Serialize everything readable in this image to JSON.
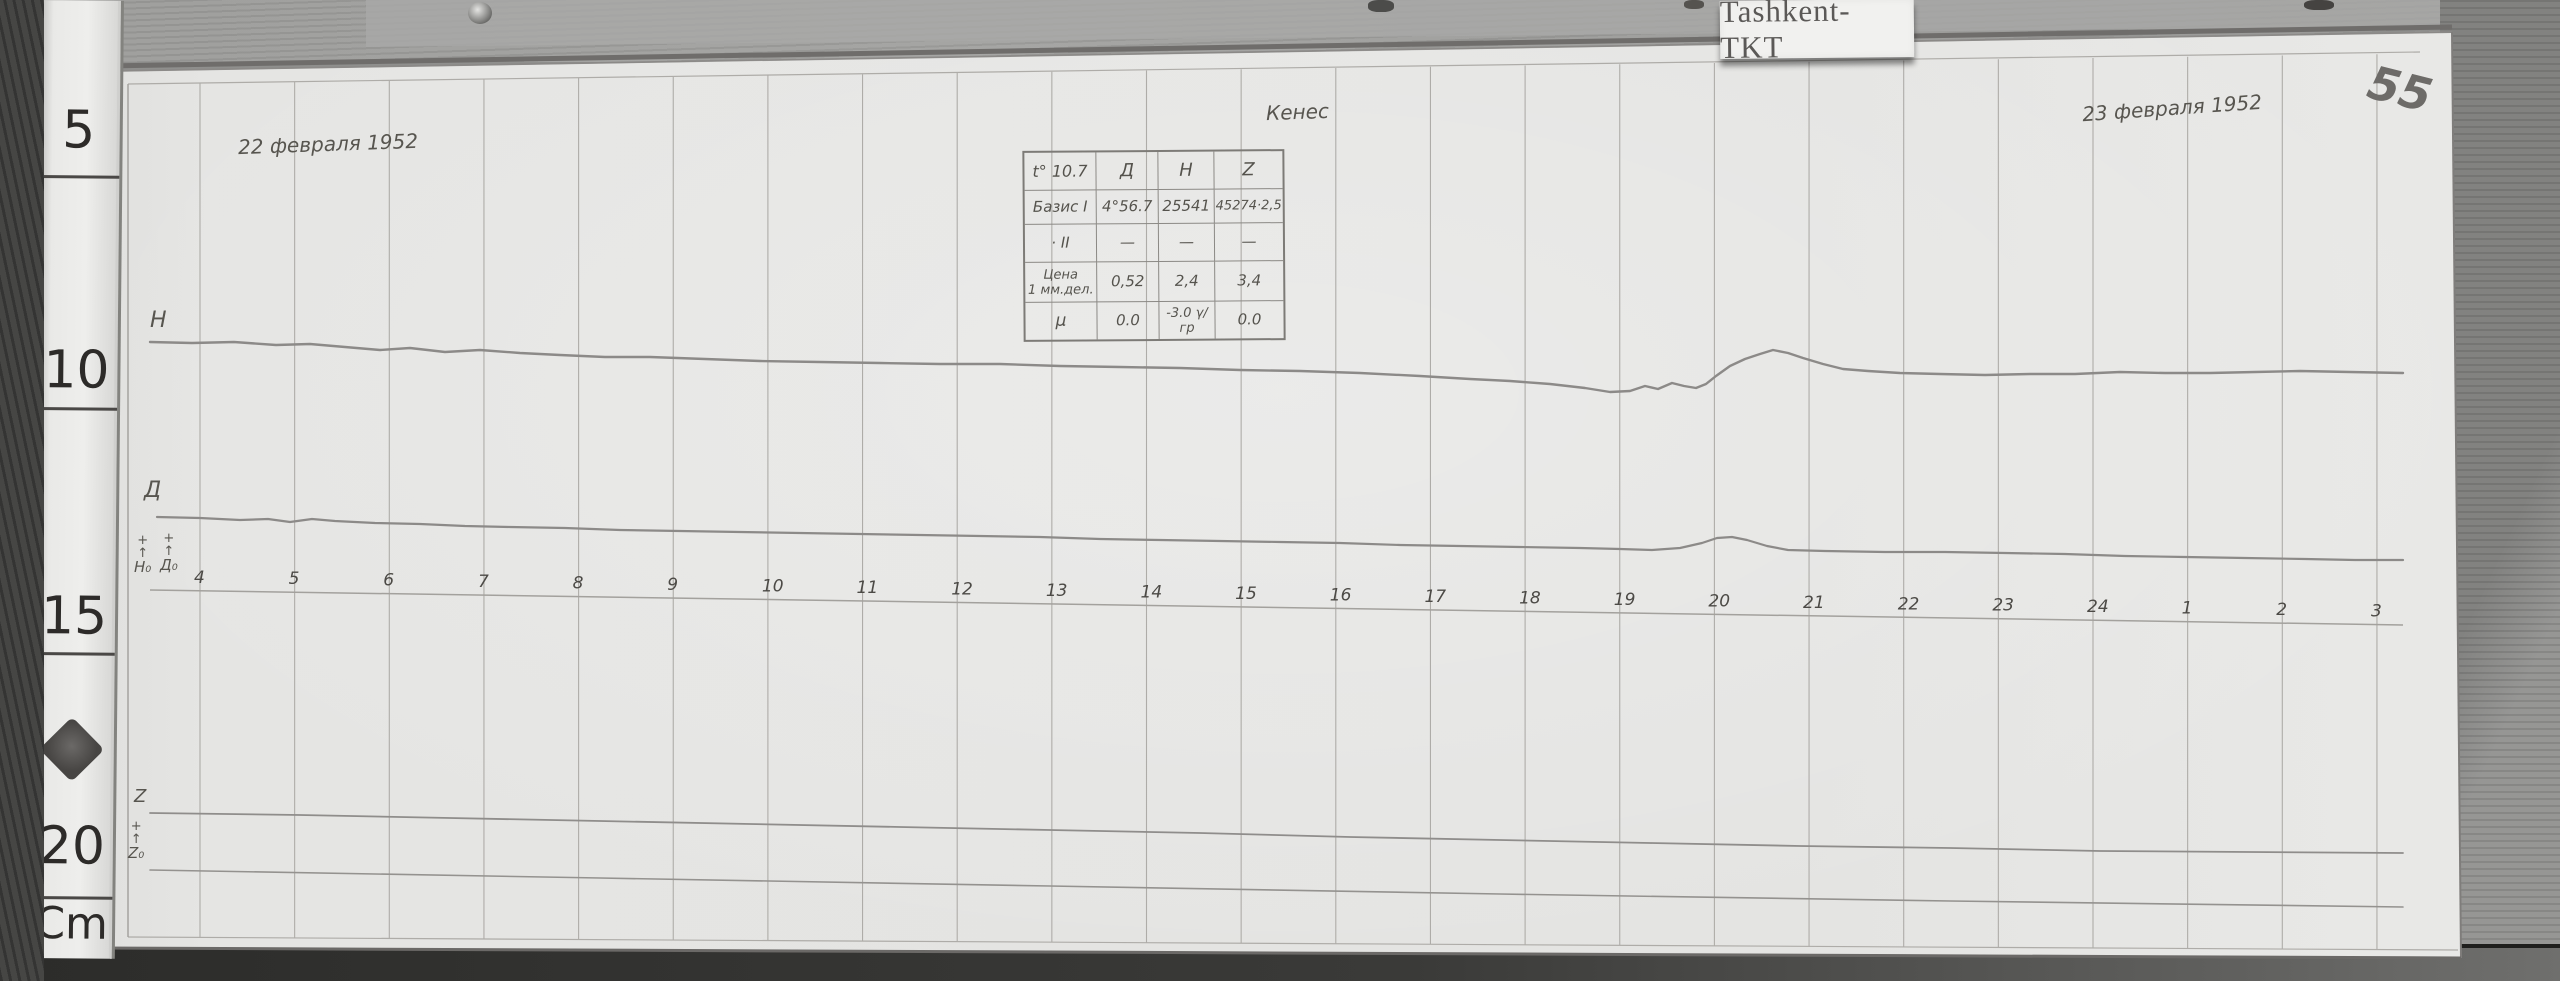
{
  "label_card": {
    "text": "Tashkent-TKT"
  },
  "annotations": {
    "date_left": "22 февраля 1952",
    "date_right": "23 февраля 1952",
    "center_note": "Кенес",
    "page_number": "55"
  },
  "ruler": {
    "marks": [
      {
        "label": "5"
      },
      {
        "label": "10"
      },
      {
        "label": "15"
      },
      {
        "label": "20"
      },
      {
        "label": "Cm"
      }
    ]
  },
  "table": {
    "rows": [
      {
        "cells": [
          "t° 10.7",
          "Д",
          "Н",
          "Z"
        ]
      },
      {
        "cells": [
          "Базис I",
          "4°56.7",
          "25541",
          "45274·2,5"
        ]
      },
      {
        "cells": [
          "· II",
          "—",
          "—",
          "—"
        ]
      },
      {
        "cells": [
          "Цена\n1 мм.дел.",
          "0,52",
          "2,4",
          "3,4"
        ]
      },
      {
        "cells": [
          "μ",
          "0.0",
          "-3.0 γ/гр",
          "0.0"
        ]
      }
    ]
  },
  "chart_data": {
    "type": "line",
    "description": "Photographed magnetogram strip (components H, D, Z with Z baseline) recorded 22–23 February 1952 at Tashkent-TKT; horizontal axis is local time in hours, vertical deflections unlabeled (scale values given in handwritten table).",
    "x_axis": {
      "unit": "hour",
      "labels": [
        "4",
        "5",
        "6",
        "7",
        "8",
        "9",
        "10",
        "11",
        "12",
        "13",
        "14",
        "15",
        "16",
        "17",
        "18",
        "19",
        "20",
        "21",
        "22",
        "23",
        "24",
        "1",
        "2",
        "3"
      ],
      "x0": 200,
      "step": 94.65,
      "line": [
        "150,590",
        "800,600",
        "1500,611",
        "2403,625"
      ]
    },
    "y_axis": {
      "labels": [],
      "note": "no numeric scale printed; 1 mm division values: D 0.52, H 2.4, Z 3.4"
    },
    "grid": {
      "color": "#aeaca8",
      "lines": [
        [
          104,
          66,
          2452,
          27,
          5,
          "#6f6d6b"
        ],
        [
          104,
          71,
          2452,
          32,
          1.5,
          "#8b8987"
        ],
        [
          2452,
          32,
          2461,
          958,
          2,
          "#7f7d7b"
        ],
        [
          97,
          948,
          2461,
          958,
          3,
          "#6b6967"
        ],
        [
          128,
          84,
          2420,
          52,
          1.2,
          "#aeaca8"
        ],
        [
          128,
          937,
          2458,
          950,
          1.2,
          "#aeaca8"
        ],
        [
          128,
          84,
          128,
          937,
          1.4,
          "#a19f9b"
        ]
      ]
    },
    "series": [
      {
        "name": "H",
        "label": "Н",
        "color": "#8c8a88",
        "width": 2.4,
        "points": [
          [
            150,
            342
          ],
          [
            192,
            343
          ],
          [
            234,
            342
          ],
          [
            276,
            345
          ],
          [
            310,
            344
          ],
          [
            345,
            347
          ],
          [
            380,
            350
          ],
          [
            410,
            348
          ],
          [
            445,
            352
          ],
          [
            480,
            350
          ],
          [
            520,
            353
          ],
          [
            560,
            355
          ],
          [
            605,
            357
          ],
          [
            650,
            357
          ],
          [
            705,
            359
          ],
          [
            760,
            361
          ],
          [
            820,
            362
          ],
          [
            880,
            363
          ],
          [
            940,
            364
          ],
          [
            1000,
            364
          ],
          [
            1060,
            366
          ],
          [
            1120,
            367
          ],
          [
            1180,
            368
          ],
          [
            1240,
            370
          ],
          [
            1300,
            371
          ],
          [
            1360,
            373
          ],
          [
            1420,
            376
          ],
          [
            1470,
            379
          ],
          [
            1510,
            381
          ],
          [
            1550,
            384
          ],
          [
            1585,
            388
          ],
          [
            1610,
            392
          ],
          [
            1630,
            391
          ],
          [
            1645,
            386
          ],
          [
            1658,
            389
          ],
          [
            1672,
            383
          ],
          [
            1684,
            386
          ],
          [
            1696,
            388
          ],
          [
            1706,
            384
          ],
          [
            1716,
            376
          ],
          [
            1730,
            366
          ],
          [
            1745,
            359
          ],
          [
            1760,
            354
          ],
          [
            1773,
            350
          ],
          [
            1788,
            353
          ],
          [
            1803,
            358
          ],
          [
            1823,
            364
          ],
          [
            1843,
            369
          ],
          [
            1868,
            371
          ],
          [
            1900,
            373
          ],
          [
            1940,
            374
          ],
          [
            1985,
            375
          ],
          [
            2030,
            374
          ],
          [
            2075,
            374
          ],
          [
            2120,
            372
          ],
          [
            2165,
            373
          ],
          [
            2210,
            373
          ],
          [
            2255,
            372
          ],
          [
            2300,
            371
          ],
          [
            2350,
            372
          ],
          [
            2403,
            373
          ]
        ]
      },
      {
        "name": "D",
        "label": "Д",
        "color": "#8c8a88",
        "width": 2.2,
        "points": [
          [
            157,
            517
          ],
          [
            200,
            518
          ],
          [
            240,
            520
          ],
          [
            268,
            519
          ],
          [
            290,
            522
          ],
          [
            312,
            519
          ],
          [
            335,
            521
          ],
          [
            375,
            523
          ],
          [
            420,
            524
          ],
          [
            465,
            526
          ],
          [
            510,
            527
          ],
          [
            565,
            528
          ],
          [
            620,
            530
          ],
          [
            680,
            531
          ],
          [
            740,
            532
          ],
          [
            800,
            533
          ],
          [
            860,
            534
          ],
          [
            920,
            535
          ],
          [
            980,
            536
          ],
          [
            1040,
            537
          ],
          [
            1100,
            539
          ],
          [
            1160,
            540
          ],
          [
            1220,
            541
          ],
          [
            1280,
            542
          ],
          [
            1340,
            543
          ],
          [
            1400,
            545
          ],
          [
            1460,
            546
          ],
          [
            1520,
            547
          ],
          [
            1580,
            548
          ],
          [
            1620,
            549
          ],
          [
            1652,
            550
          ],
          [
            1680,
            548
          ],
          [
            1702,
            543
          ],
          [
            1717,
            538
          ],
          [
            1732,
            537
          ],
          [
            1747,
            540
          ],
          [
            1767,
            546
          ],
          [
            1788,
            550
          ],
          [
            1825,
            551
          ],
          [
            1885,
            552
          ],
          [
            1945,
            552
          ],
          [
            2005,
            553
          ],
          [
            2065,
            554
          ],
          [
            2125,
            556
          ],
          [
            2185,
            557
          ],
          [
            2245,
            558
          ],
          [
            2305,
            559
          ],
          [
            2355,
            560
          ],
          [
            2403,
            560
          ]
        ]
      },
      {
        "name": "Z",
        "label": "Z",
        "color": "#8f8d8b",
        "width": 1.8,
        "points": [
          [
            150,
            813
          ],
          [
            300,
            815
          ],
          [
            450,
            818
          ],
          [
            600,
            821
          ],
          [
            750,
            824
          ],
          [
            900,
            827
          ],
          [
            1050,
            830
          ],
          [
            1200,
            833
          ],
          [
            1350,
            837
          ],
          [
            1500,
            840
          ],
          [
            1650,
            843
          ],
          [
            1800,
            846
          ],
          [
            1950,
            848
          ],
          [
            2100,
            851
          ],
          [
            2250,
            852
          ],
          [
            2403,
            853
          ]
        ]
      },
      {
        "name": "Z0-baseline",
        "label": "Z₀",
        "color": "#94928f",
        "width": 1.6,
        "points": [
          [
            150,
            870
          ],
          [
            600,
            878
          ],
          [
            1050,
            886
          ],
          [
            1500,
            894
          ],
          [
            1950,
            901
          ],
          [
            2403,
            907
          ]
        ]
      }
    ],
    "baseline_marks": [
      {
        "label": "Н₀",
        "symbols": [
          "+",
          "↑"
        ]
      },
      {
        "label": "Д₀",
        "symbols": [
          "+",
          "↑"
        ]
      },
      {
        "label": "Z₀",
        "symbols": [
          "+",
          "↑"
        ]
      }
    ],
    "legend": "none",
    "grid_on": true
  }
}
